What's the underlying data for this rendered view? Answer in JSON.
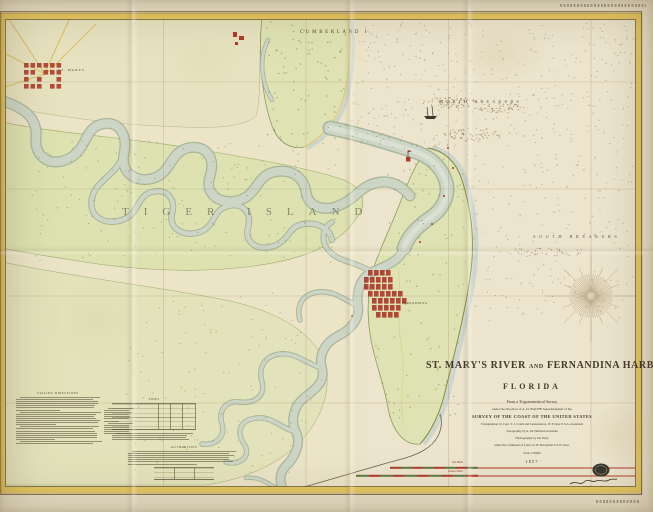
{
  "title_block": {
    "title_part1": "ST. MARY'S RIVER",
    "title_and": "AND",
    "title_part2": "FERNANDINA HARBOR",
    "state": "FLORIDA",
    "line_survey": "From a Trigonometrical Survey",
    "line_direction": "under the direction of A. D. BACHE Superintendent of the",
    "line_coast": "SURVEY OF THE COAST OF THE UNITED STATES",
    "line_triangulation": "Triangulation by Capt. T. J. Cram and Lieutenant A. W. Evans U.S.A. Assistants",
    "line_topography": "Topography by A. M. Harrison Assistant",
    "line_hydrography": "Hydrography by the Party",
    "line_command": "under the command of Lieut. O. H. Berryman U.S.N. Asst.",
    "line_scale": "Scale 1/30000",
    "date": "1857"
  },
  "geo_labels": {
    "cumberland_island": "CUMBERLAND I.",
    "north_breakers": "NORTH BREAKERS",
    "south_breakers": "SOUTH BREAKERS",
    "tiger_island": "TIGER ISLAND",
    "st_marys_town": "ST. MARYS",
    "fernandina_town": "FERNANDINA"
  },
  "notes": {
    "sailing_directions_title": "SAILING DIRECTIONS",
    "tide_table_title": "TIDES",
    "authorities_title": "AUTHORITIES"
  },
  "scale_bars": {
    "sea_miles_label": "Sea Miles",
    "statute_miles_label": "Statute Miles"
  },
  "colors": {
    "border_yellow": "#e6c75f",
    "town_red": "#ae3a2b",
    "marsh_green": "#dde2b0",
    "river": "#c9d3c3",
    "sea_blue": "#b7ccd1",
    "ink": "#43392b"
  }
}
